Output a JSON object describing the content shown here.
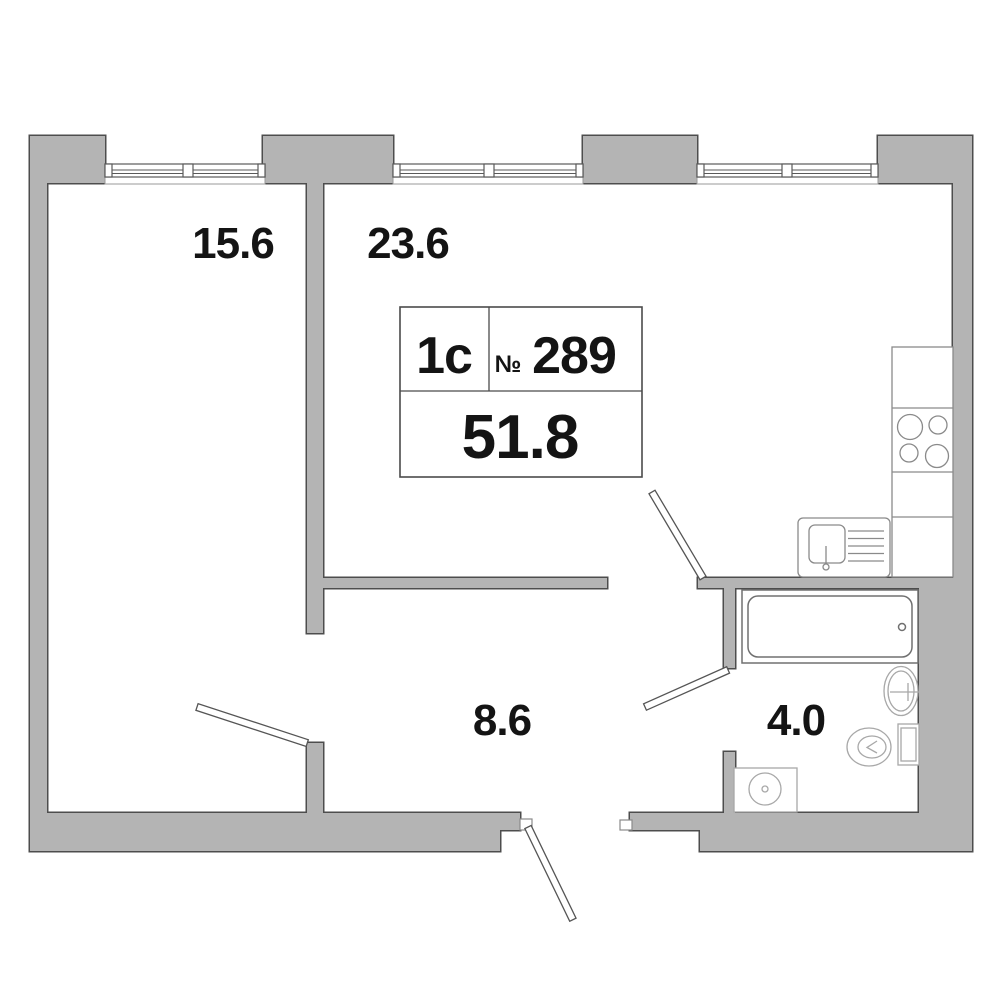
{
  "unit_card": {
    "type_label": "1с",
    "number_sign": "№",
    "number": "289",
    "total_area": "51.8"
  },
  "rooms": [
    {
      "id": "bedroom",
      "area": "15.6"
    },
    {
      "id": "kitchen-living",
      "area": "23.6"
    },
    {
      "id": "hallway",
      "area": "8.6"
    },
    {
      "id": "bathroom",
      "area": "4.0"
    }
  ],
  "colors": {
    "background": "#ffffff",
    "wall_fill": "#b4b4b4",
    "wall_outline": "#4d4d4d",
    "fixture_outline": "#8a8a8a",
    "text": "#141414"
  }
}
